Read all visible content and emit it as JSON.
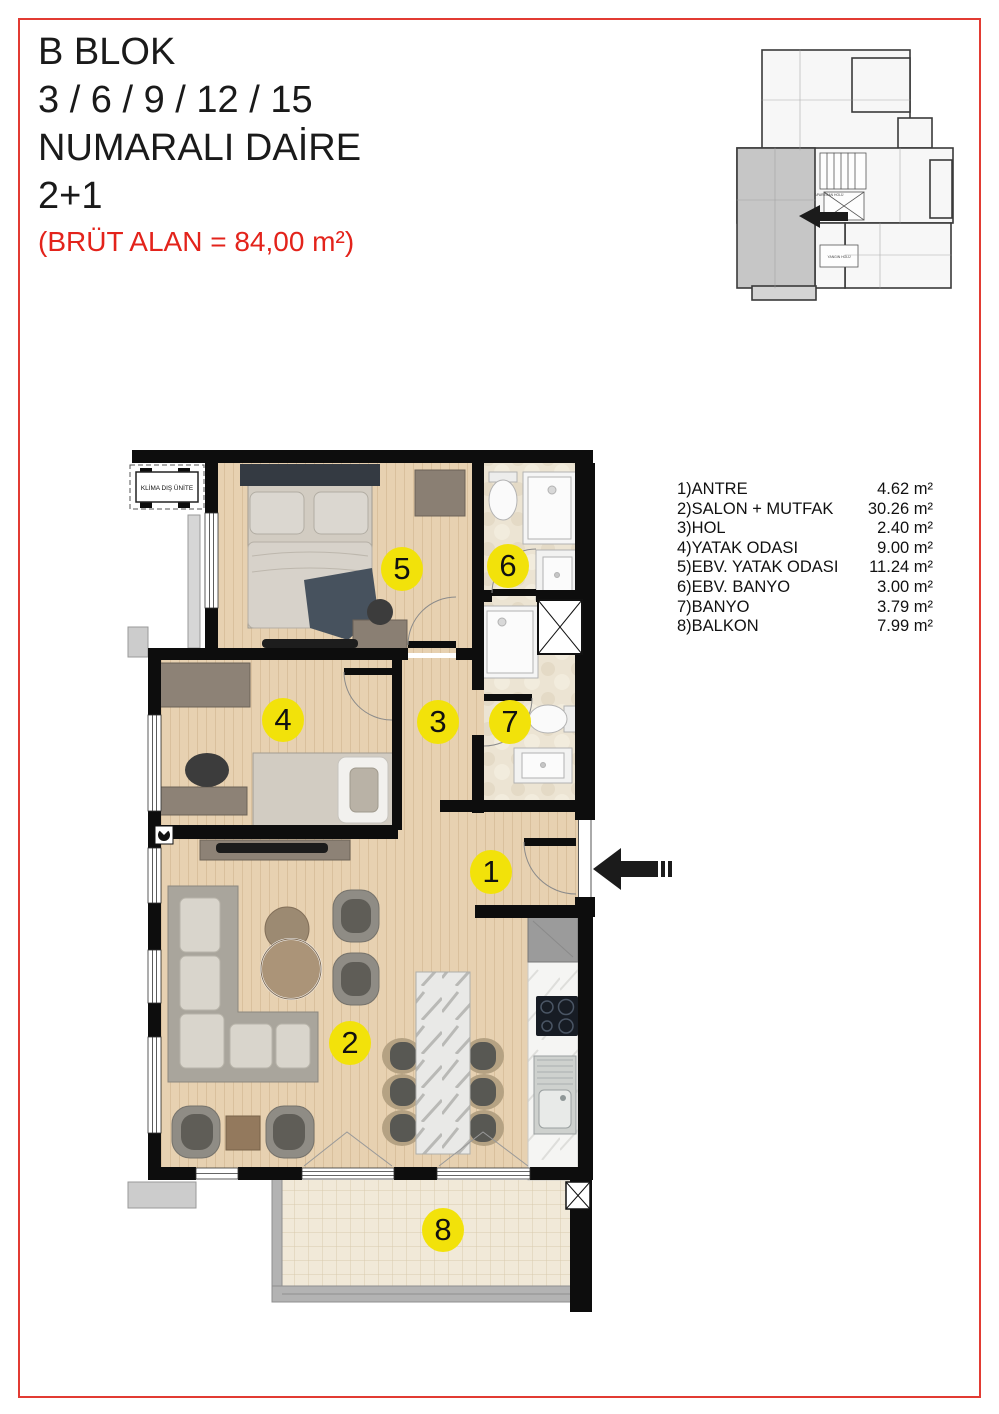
{
  "page": {
    "border_color": "#e23b33"
  },
  "title_block": {
    "line1": "B BLOK",
    "line2": "3 / 6 / 9 / 12 / 15",
    "line3": "NUMARALI DAİRE",
    "line4": "2+1",
    "area_note": "(BRÜT ALAN = 84,00 m²)"
  },
  "key_plan": {
    "labels": {
      "apartman_holu": "APARTMAN HOLÜ",
      "yangin_holu": "YANGIN HOLÜ"
    }
  },
  "legend": {
    "items": [
      {
        "label": "1)ANTRE",
        "value": "4.62 m²"
      },
      {
        "label": "2)SALON + MUTFAK",
        "value": "30.26 m²"
      },
      {
        "label": "3)HOL",
        "value": "2.40 m²"
      },
      {
        "label": "4)YATAK ODASI",
        "value": "9.00 m²"
      },
      {
        "label": "5)EBV. YATAK ODASI",
        "value": "11.24 m²"
      },
      {
        "label": "6)EBV. BANYO",
        "value": "3.00 m²"
      },
      {
        "label": "7)BANYO",
        "value": "3.79 m²"
      },
      {
        "label": "8)BALKON",
        "value": "7.99 m²"
      }
    ]
  },
  "plan": {
    "klima_label": "KLİMA DIŞ ÜNİTE",
    "marker_color": "#f2e20a",
    "room_markers": [
      {
        "num": "5",
        "x": 402,
        "y": 569
      },
      {
        "num": "6",
        "x": 508,
        "y": 566
      },
      {
        "num": "4",
        "x": 283,
        "y": 720
      },
      {
        "num": "3",
        "x": 438,
        "y": 722
      },
      {
        "num": "7",
        "x": 510,
        "y": 722
      },
      {
        "num": "1",
        "x": 491,
        "y": 872
      },
      {
        "num": "2",
        "x": 350,
        "y": 1043
      },
      {
        "num": "8",
        "x": 443,
        "y": 1230
      }
    ]
  }
}
